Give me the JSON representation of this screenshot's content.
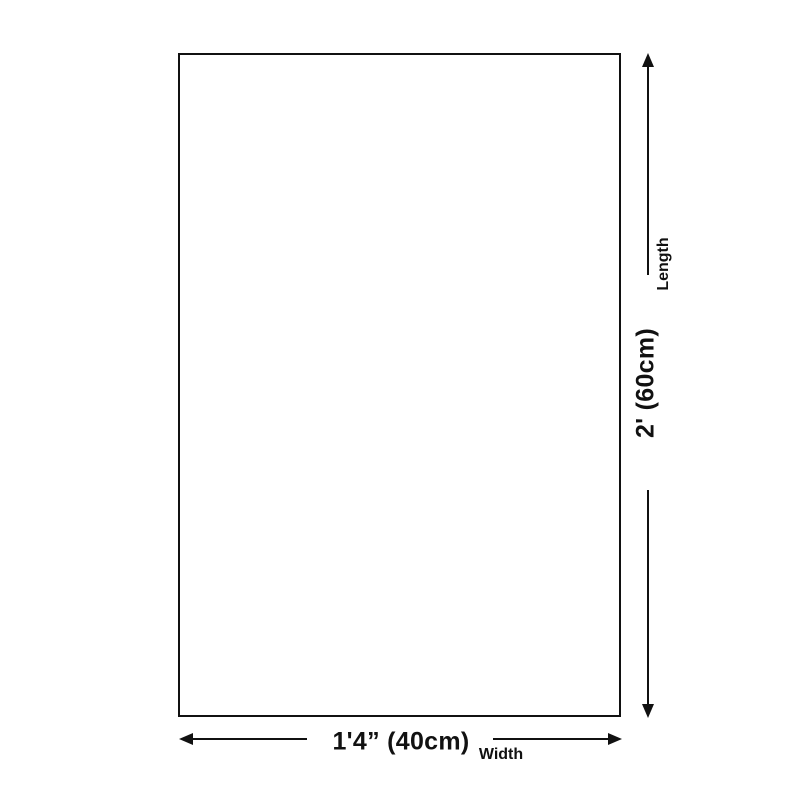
{
  "diagram": {
    "background_color": "#ffffff",
    "ink_color": "#111111",
    "shape": "rectangle-outline",
    "width_dimension": {
      "value": "1'4” (40cm)",
      "axis_label": "Width",
      "arrow_icons": [
        "arrow-left-icon",
        "arrow-right-icon"
      ]
    },
    "length_dimension": {
      "value": "2' (60cm)",
      "axis_label": "Length",
      "arrow_icons": [
        "arrow-up-icon",
        "arrow-down-icon"
      ]
    }
  }
}
